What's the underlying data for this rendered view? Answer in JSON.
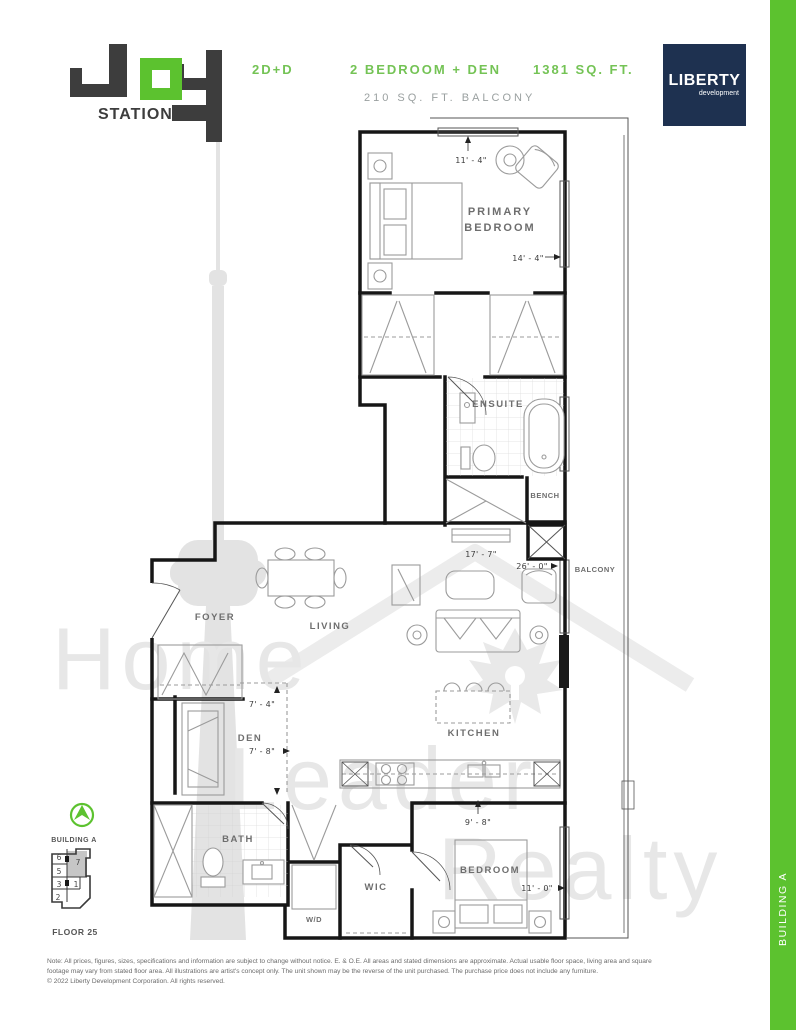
{
  "page": {
    "accent_green": "#5cc22f",
    "text_green": "#74c355",
    "navy": "#1e3150",
    "logo_dark": "#3d3d3d",
    "sidebar_label": "BUILDING A"
  },
  "header": {
    "logo_word": "JOY",
    "logo_sub": "STATION",
    "model": "2D+D",
    "unit_type": "2 BEDROOM + DEN",
    "area": "1381 SQ. FT.",
    "balcony_area": "210 SQ. FT. BALCONY",
    "developer_name": "LIBERTY",
    "developer_sub": "development"
  },
  "floorplan": {
    "labels": {
      "primary1": "PRIMARY",
      "primary2": "BEDROOM",
      "ensuite": "ENSUITE",
      "bench": "BENCH",
      "balcony": "BALCONY",
      "foyer": "FOYER",
      "living": "LIVING",
      "den": "DEN",
      "kitchen": "KITCHEN",
      "bath": "BATH",
      "wic": "WIC",
      "wd": "W/D",
      "bedroom": "BEDROOM"
    },
    "dims": {
      "primary_w": "11' - 4\"",
      "primary_d": "14' - 4\"",
      "ensuite_w": "17' - 7\"",
      "balcony_l": "26' - 0\"",
      "den_w": "7' - 4\"",
      "den_d": "7' - 8\"",
      "bedroom_w": "9' - 8\"",
      "bedroom_d": "11' - 0\""
    }
  },
  "keyplan": {
    "building": "BUILDING A",
    "floor": "FLOOR 25",
    "units": [
      "6",
      "7",
      "5",
      "3",
      "1",
      "2"
    ],
    "highlighted_unit": "7"
  },
  "watermark": {
    "line1": "Home",
    "line2": "Leader",
    "line3": "Realty"
  },
  "footer": {
    "note": "Note: All prices, figures, sizes, specifications and information are subject to change without notice. E. & O.E. All areas and stated dimensions are approximate. Actual usable floor space, living area and square footage may vary from stated floor area. All illustrations are artist's concept only. The unit shown may be the reverse of the unit purchased. The purchase price does not include any furniture.",
    "copyright": "© 2022 Liberty Development Corporation. All rights reserved."
  }
}
